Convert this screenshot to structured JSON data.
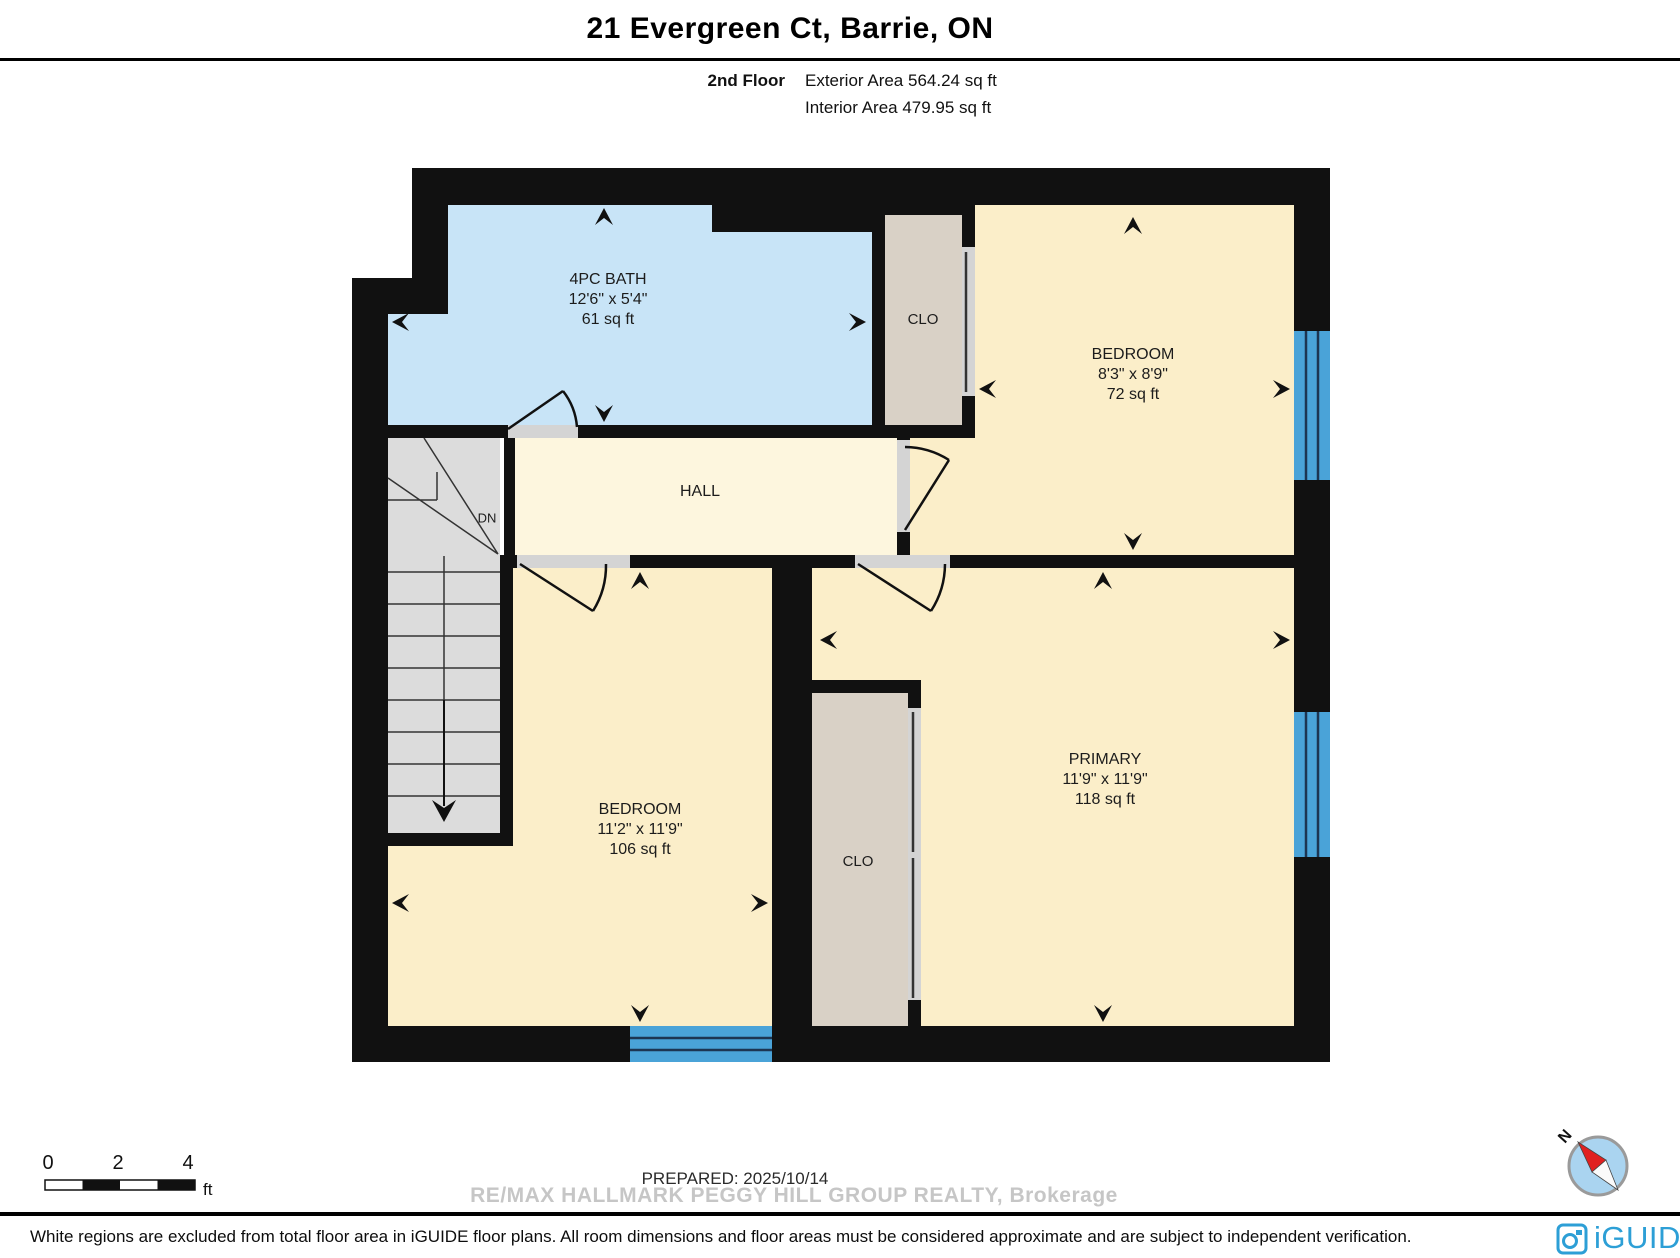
{
  "header": {
    "title": "21 Evergreen Ct, Barrie, ON",
    "floor_label": "2nd Floor",
    "exterior_area": "Exterior Area 564.24 sq ft",
    "interior_area": "Interior Area 479.95 sq ft"
  },
  "rooms": {
    "bath": {
      "name": "4PC BATH",
      "dimensions": "12'6\" x 5'4\"",
      "area": "61 sq ft"
    },
    "closet_top": {
      "name": "CLO"
    },
    "bedroom_top": {
      "name": "BEDROOM",
      "dimensions": "8'3\" x 8'9\"",
      "area": "72 sq ft"
    },
    "hall": {
      "name": "HALL"
    },
    "stairs": {
      "label": "DN"
    },
    "bedroom_bottom": {
      "name": "BEDROOM",
      "dimensions": "11'2\" x 11'9\"",
      "area": "106 sq ft"
    },
    "closet_bottom": {
      "name": "CLO"
    },
    "primary": {
      "name": "PRIMARY",
      "dimensions": "11'9\" x 11'9\"",
      "area": "118 sq ft"
    }
  },
  "scale_bar": {
    "tick_0": "0",
    "tick_2": "2",
    "tick_4": "4",
    "unit": "ft"
  },
  "compass": {
    "label": "N"
  },
  "footer": {
    "prepared": "PREPARED: 2025/10/14",
    "watermark": "RE/MAX HALLMARK PEGGY HILL GROUP REALTY, Brokerage",
    "disclaimer": "White regions are excluded from total floor area in iGUIDE floor plans. All room dimensions and floor areas must be considered approximate and are subject to independent verification.",
    "brand": "iGUIDE"
  },
  "colors": {
    "wall": "#111111",
    "bath_floor": "#c8e4f7",
    "room_floor": "#fbeec9",
    "hall_floor": "#fdf6de",
    "closet_floor": "#d9d1c6",
    "stairs_floor": "#dcdcdc",
    "window_blue": "#4aa3d8",
    "logo_blue": "#2d9fd6",
    "compass_red": "#e02020"
  }
}
